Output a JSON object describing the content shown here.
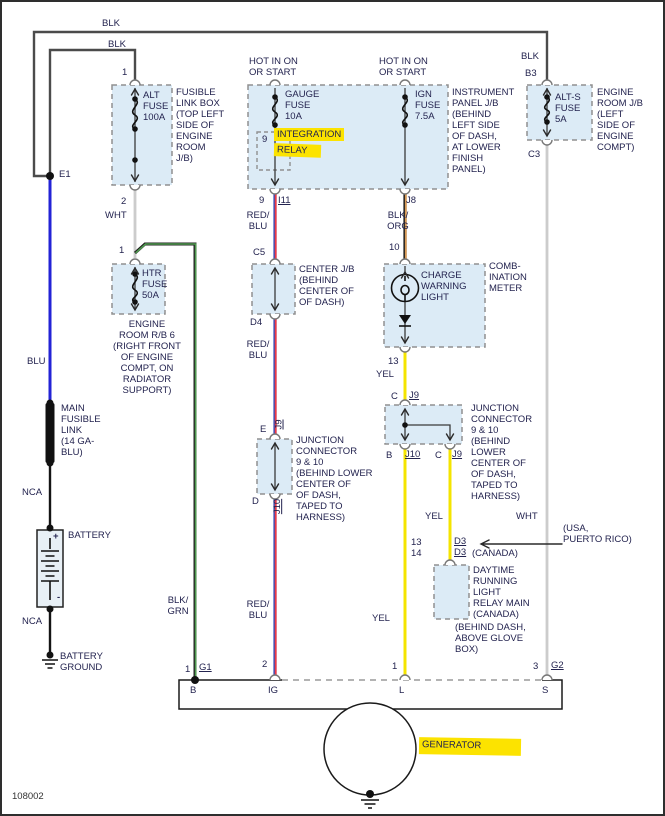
{
  "diagram": {
    "id": "108002",
    "type": "wiring-diagram",
    "subject": "charging system / generator circuit"
  },
  "colors": {
    "blk": "#4b4b4b",
    "wht": "#cccccc",
    "blu": "#2323d6",
    "red": "#ee3a45",
    "red_edge": "#3a4fb8",
    "org": "#d89a55",
    "dark": "#1f1f1f",
    "yel": "#f4e400",
    "grn": "#4f9a4f",
    "text": "#23234f",
    "box_fill": "#dcebf6",
    "box_stroke": "#909090",
    "highlight": "#fce300"
  },
  "labels": {
    "blk_top": "BLK",
    "blk_left": "BLK",
    "e1": "E1",
    "alt_t1": "1",
    "alt_fuse": "ALT\nFUSE\n100A",
    "fusible_link_box": "FUSIBLE\nLINK BOX\n(TOP LEFT\nSIDE OF\nENGINE\nROOM\nJ/B)",
    "alt_t2": "2",
    "wht_1": "WHT",
    "htr_t1": "1",
    "htr_fuse": "HTR\nFUSE\n50A",
    "engine_room_rb6": "ENGINE\nROOM R/B 6\n(RIGHT FRONT\nOF ENGINE\nCOMPT, ON\nRADIATOR\nSUPPORT)",
    "blu": "BLU",
    "main_fusible_link": "MAIN\nFUSIBLE\nLINK\n(14 GA-\nBLU)",
    "nca_1": "NCA",
    "battery": "BATTERY",
    "battery_plus": "+",
    "battery_minus": "-",
    "nca_2": "NCA",
    "battery_ground": "BATTERY\nGROUND",
    "hot_1": "HOT IN ON\nOR START",
    "hot_2": "HOT IN ON\nOR START",
    "gauge_fuse": "GAUGE\nFUSE\n10A",
    "ign_fuse": "IGN\nFUSE\n7.5A",
    "relay_9": "9",
    "integration_1": "INTEGRATION",
    "integration_2": "RELAY",
    "instrument_panel": "INSTRUMENT\nPANEL J/B\n(BEHIND\nLEFT SIDE\nOF DASH,\nAT LOWER\nFINISH\nPANEL)",
    "out_9": "9",
    "i11": "I11",
    "j8": "J8",
    "red_blu_1": "RED/\nBLU",
    "blk_org": "BLK/\nORG",
    "c5": "C5",
    "center_jb": "CENTER J/B\n(BEHIND\nCENTER OF\nOF DASH)",
    "d4": "D4",
    "red_blu_2": "RED/\nBLU",
    "t10": "10",
    "charge_warning": "CHARGE\nWARNING\nLIGHT",
    "combination_meter": "COMB-\nINATION\nMETER",
    "t13": "13",
    "yel_1": "YEL",
    "c_top": "C",
    "j9_top": "J9",
    "junction_right": "JUNCTION\nCONNECTOR\n9 & 10\n(BEHIND\nLOWER\nCENTER OF\nOF DASH,\nTAPED TO\nHARNESS)",
    "b_term": "B",
    "j10_right": "J10",
    "c_bot": "C",
    "j9_bot": "J9",
    "e_term": "E",
    "j9_mid": "J9",
    "d_term": "D",
    "j10_mid": "J10",
    "junction_mid": "JUNCTION\nCONNECTOR\n9 & 10\n(BEHIND LOWER\nCENTER OF\nOF DASH,\nTAPED TO\nHARNESS)",
    "red_blu_3": "RED/\nBLU",
    "blk_grn": "BLK/\nGRN",
    "yel_2": "YEL",
    "yel_3": "YEL",
    "wht_3": "WHT",
    "usa_pr": "(USA,\nPUERTO RICO)",
    "t13_d3": "13",
    "d3_usa": "D3",
    "t14_d3": "14",
    "d3_can": "D3",
    "canada": "(CANADA)",
    "drl_relay": "DAYTIME\nRUNNING\nLIGHT\nRELAY MAIN\n(CANADA)",
    "drl_loc": "(BEHIND DASH,\nABOVE GLOVE\nBOX)",
    "g1_t": "1",
    "g1": "G1",
    "ig_t": "2",
    "l_t": "1",
    "g2_t": "3",
    "g2": "G2",
    "gen_b": "B",
    "gen_ig": "IG",
    "gen_l": "L",
    "gen_s": "S",
    "generator": "GENERATOR",
    "blk_b3": "BLK",
    "b3": "B3",
    "alt_s_fuse": "ALT-S\nFUSE\n5A",
    "c3": "C3",
    "engine_room_jb": "ENGINE\nROOM J/B\n(LEFT\nSIDE OF\nENGINE\nCOMPT)",
    "diagram_id": "108002"
  }
}
